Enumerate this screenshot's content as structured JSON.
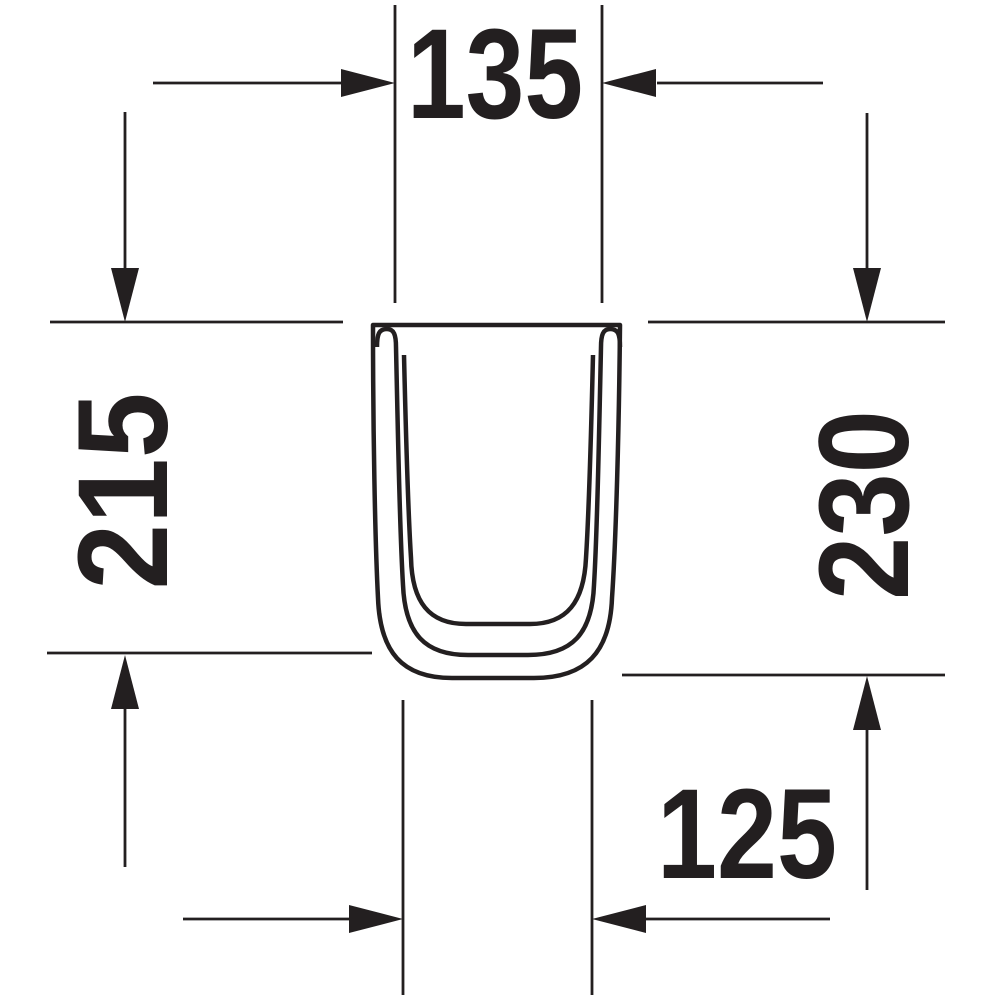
{
  "drawing": {
    "dimensions": {
      "top_width": "135",
      "left_height": "215",
      "right_height": "230",
      "bottom_width": "125"
    },
    "colors": {
      "line": "#231f20",
      "background": "#ffffff"
    }
  }
}
